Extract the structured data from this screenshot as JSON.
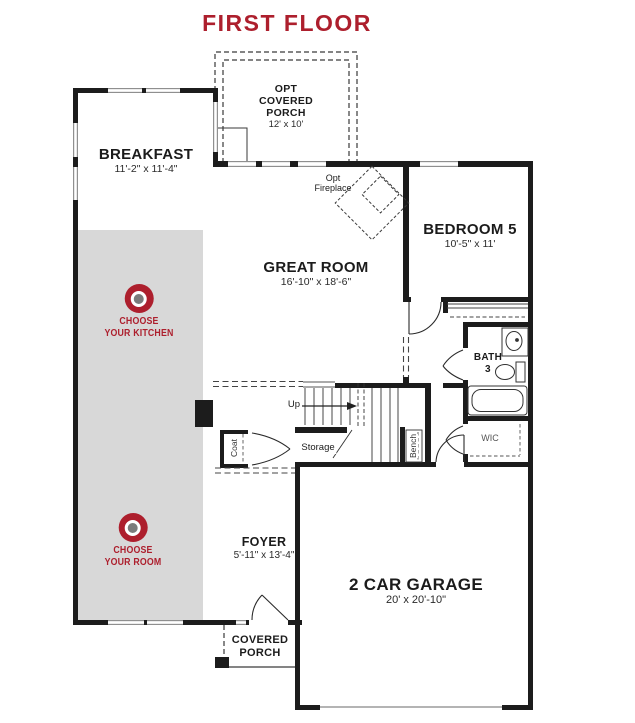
{
  "title": "FIRST FLOOR",
  "colors": {
    "accent_red": "#ad1f2d",
    "wall_black": "#1c1c1c",
    "zone_gray": "#d8d8d8",
    "marker_center_gray": "#7b7b7b"
  },
  "rooms": {
    "opt_covered_porch": {
      "name": "OPT\nCOVERED\nPORCH",
      "dims": "12' x 10'"
    },
    "breakfast": {
      "name": "BREAKFAST",
      "dims": "11'-2\" x 11'-4\""
    },
    "great_room": {
      "name": "GREAT ROOM",
      "dims": "16'-10\" x 18'-6\""
    },
    "bedroom_5": {
      "name": "BEDROOM 5",
      "dims": "10'-5\" x 11'"
    },
    "bath_3": {
      "name": "BATH\n3"
    },
    "wic": {
      "name": "WIC"
    },
    "foyer": {
      "name": "FOYER",
      "dims": "5'-11\" x 13'-4\""
    },
    "garage": {
      "name": "2 CAR GARAGE",
      "dims": "20' x 20'-10\""
    },
    "covered_porch": {
      "name": "COVERED\nPORCH"
    }
  },
  "annotations": {
    "opt_fireplace": "Opt\nFireplace",
    "up": "Up",
    "storage": "Storage",
    "coat": "Coat",
    "bench": "Bench"
  },
  "hotspots": {
    "kitchen": {
      "label": "CHOOSE\nYOUR KITCHEN"
    },
    "room": {
      "label": "CHOOSE\nYOUR ROOM"
    }
  }
}
